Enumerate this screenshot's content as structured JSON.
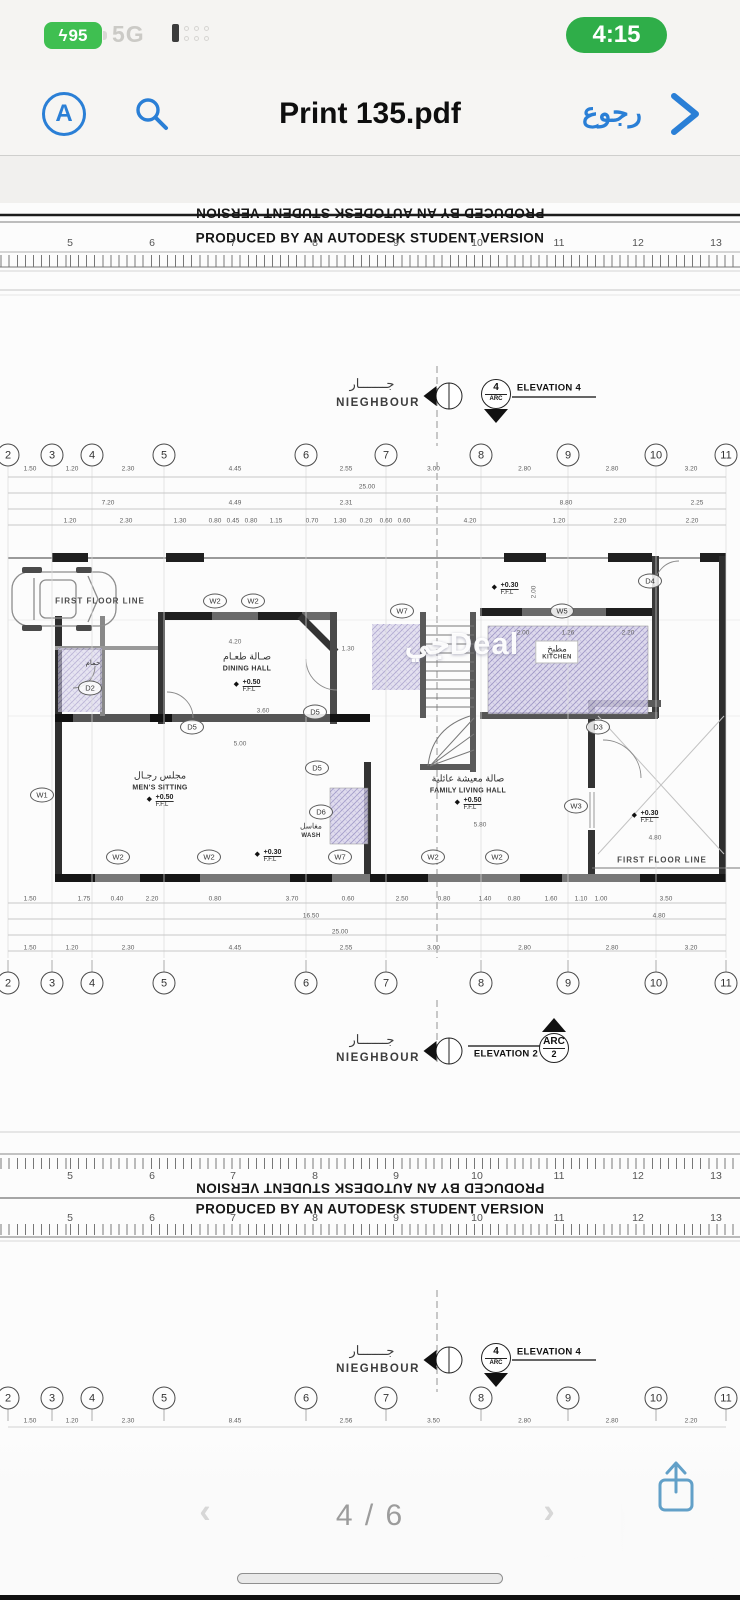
{
  "status_bar": {
    "battery_percent": "95",
    "network": "5G",
    "time": "4:15"
  },
  "toolbar": {
    "a_icon_letter": "A",
    "title": "Print 135.pdf",
    "back_label": "رجوع"
  },
  "pdf": {
    "autodesk_banner": "PRODUCED BY AN AUTODESK STUDENT VERSION",
    "ruler_numbers": [
      "5",
      "6",
      "7",
      "8",
      "9",
      "10",
      "11",
      "12",
      "13"
    ],
    "grid_bubbles": [
      "2",
      "3",
      "4",
      "5",
      "6",
      "7",
      "8",
      "9",
      "10",
      "11"
    ],
    "neighbour": {
      "ar": "جـــــــار",
      "en": "NIEGHBOUR"
    },
    "elevations": {
      "top": {
        "num": "4",
        "arc": "ARC",
        "label": "ELEVATION 4"
      },
      "middle": {
        "num": "2",
        "arc": "ARC",
        "label": "ELEVATION 2"
      },
      "bottom": {
        "num": "4",
        "arc": "ARC",
        "label": "ELEVATION 4"
      }
    },
    "dims": {
      "top_row1": [
        "1.50",
        "1.20",
        "2.30",
        "4.45",
        "2.55",
        "3.00",
        "2.80",
        "2.80",
        "3.20"
      ],
      "top_total": "25.00",
      "top_row2": [
        "7.20",
        "4.49",
        "2.31",
        "8.80",
        "2.25"
      ],
      "top_row3": [
        "1.20",
        "2.30",
        "1.30",
        "0.80",
        "0.45",
        "0.80",
        "1.15",
        "0.70",
        "1.30",
        "0.20",
        "0.60",
        "0.60",
        "4.20",
        "1.20",
        "2.20",
        "2.20"
      ],
      "bottom_row1": [
        "1.50",
        "1.75",
        "0.40",
        "2.20",
        "0.80",
        "3.70",
        "0.60",
        "2.50",
        "0.80",
        "1.40",
        "0.80",
        "1.60",
        "1.10",
        "1.00",
        "3.50"
      ],
      "bottom_row2": [
        "16.50",
        "4.80"
      ],
      "bottom_total": "25.00",
      "bottom_row3": [
        "1.50",
        "1.20",
        "2.30",
        "4.45",
        "2.55",
        "3.00",
        "2.80",
        "2.80",
        "3.20"
      ],
      "sheet2_row": [
        "1.50",
        "1.20",
        "2.30",
        "8.45",
        "2.56",
        "3.50",
        "2.80",
        "2.80",
        "2.20"
      ]
    },
    "rooms": {
      "dining": {
        "ar": "صـالة طعـام",
        "en": "DINING HALL"
      },
      "mens": {
        "ar": "مجلس رجـال",
        "en": "MEN'S SITTING"
      },
      "family": {
        "ar": "صالة معيشة عائلية",
        "en": "FAMILY LIVING HALL"
      },
      "kitchen": {
        "ar": "مطبخ",
        "en": "KITCHEN"
      },
      "wash": {
        "ar": "مغاسل",
        "en": "WASH"
      },
      "bath": {
        "ar": "حمام"
      }
    },
    "levels": {
      "ffl_050": "+0.50",
      "ffl_030": "+0.30",
      "ffl": "F.F.L"
    },
    "first_floor_line": "FIRST FLOOR LINE",
    "markers": {
      "w1": "W1",
      "w2": "W2",
      "w3": "W3",
      "w5": "W5",
      "w7": "W7",
      "d2": "D2",
      "d3": "D3",
      "d4": "D4",
      "d5": "D5",
      "d6": "D6"
    },
    "inline_dims": [
      "4.20",
      "3.60",
      "5.00",
      "5.80",
      "2.00",
      "1.26",
      "2.20",
      "1.30",
      "4.80",
      "2.00"
    ],
    "watermark": "جيDeal"
  },
  "footer": {
    "page_indicator": "4 / 6",
    "prev_glyph": "‹",
    "next_glyph": "›",
    "watermark": "حراج"
  }
}
